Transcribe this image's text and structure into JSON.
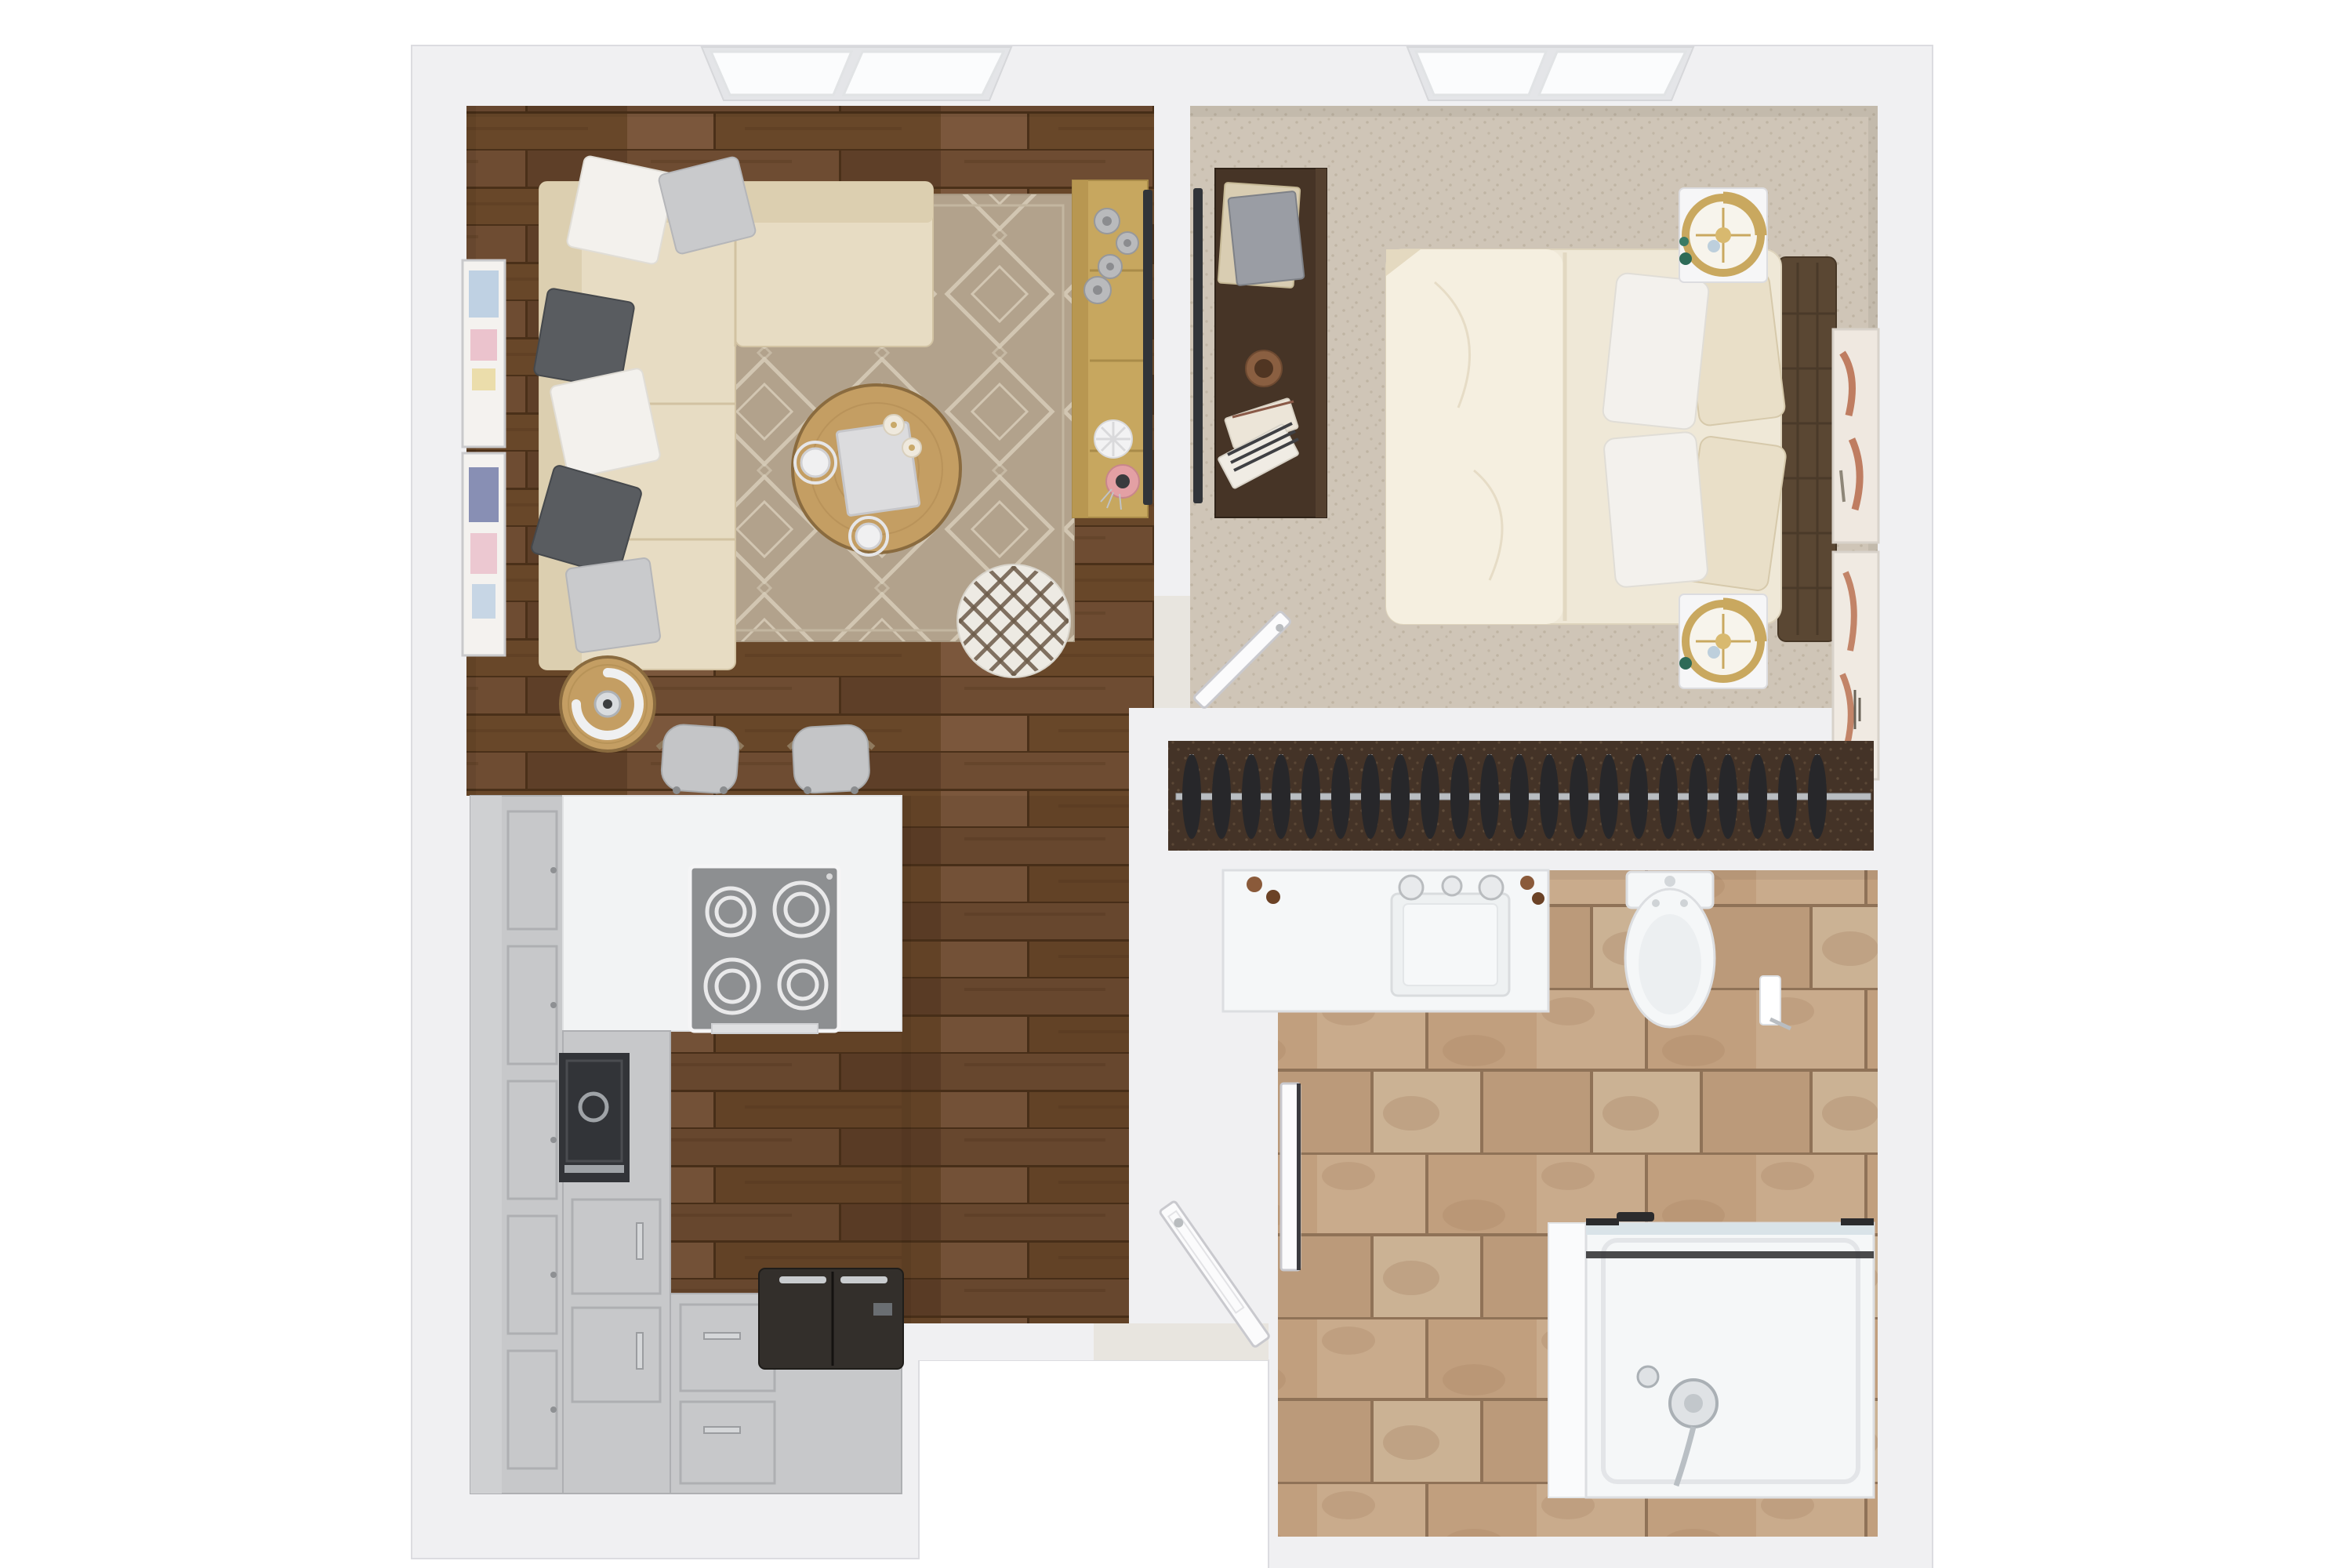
{
  "scene": {
    "type": "3d-floor-plan-top-down",
    "description": "Top-down 3D architectural rendering of a one-bedroom apartment",
    "visible_text": [],
    "rooms": [
      {
        "id": "living-room",
        "floor": "dark hardwood planks",
        "features": [
          "double window",
          "area rug"
        ]
      },
      {
        "id": "kitchen",
        "floor": "dark hardwood planks",
        "layout": "L-shaped gray cabinets with white peninsula counter"
      },
      {
        "id": "hallway",
        "floor": "dark hardwood planks"
      },
      {
        "id": "entry",
        "feature": "open front door at recessed porch"
      },
      {
        "id": "bedroom",
        "floor": "beige carpet",
        "features": [
          "double window"
        ]
      },
      {
        "id": "closet",
        "floor": "dark brown carpet",
        "features": [
          "hanging rod with clothes hangers"
        ]
      },
      {
        "id": "bathroom",
        "floor": "beige stone tile"
      }
    ]
  },
  "living_room": {
    "furniture": [
      "l-shaped-sectional-sofa",
      "throw-pillows",
      "round-coffee-table",
      "round-pouf",
      "round-side-table-with-arc-lamp",
      "media-console",
      "wall-mounted-tv",
      "wall-art-frames",
      "area-rug"
    ],
    "sofa_pillow_count": 6,
    "coffee_table_items": [
      "book",
      "two-cups-with-saucers",
      "two-candles"
    ],
    "console_items": [
      "gray-candle-cups",
      "white-flower-dish",
      "pink-vase-with-plant"
    ]
  },
  "kitchen": {
    "appliances": [
      "four-burner-cooktop",
      "wall-oven",
      "refrigerator"
    ],
    "burner_count": 4,
    "bar_stool_count": 2,
    "cabinet_finish": "gray shaker"
  },
  "bedroom": {
    "furniture": [
      "queen-bed",
      "tufted-headboard",
      "two-nightstands",
      "two-gold-ring-lamps",
      "desk-dresser",
      "wall-mounted-tv",
      "wall-art-canvases"
    ],
    "bed_pillow_count": 4,
    "nightstand_count": 2
  },
  "closet": {
    "hanger_count": 22,
    "rod": "metal closet rod"
  },
  "bathroom": {
    "fixtures": [
      "vanity-with-sink",
      "toilet",
      "toilet-paper-holder",
      "walk-in-shower-with-glass-panel",
      "chrome-shower-set"
    ],
    "open_door": true
  },
  "entry": {
    "door_state": "open",
    "porch": "recessed exterior notch at bottom center"
  },
  "windows": [
    {
      "room": "living-room",
      "pane_count": 2
    },
    {
      "room": "bedroom",
      "pane_count": 2
    }
  ],
  "colors": {
    "background": "#ffffff",
    "wall": "#f0f0f2",
    "wall_edge": "#dcdce0",
    "wood_1": "#6e4c32",
    "wood_2": "#5e3f28",
    "wood_3": "#7b573c",
    "wood_4": "#684729",
    "wood_gap": "#4a3019",
    "rug_base": "#b2a28c",
    "rug_pattern": "#d9cfbc",
    "sofa": "#e7dcc3",
    "sofa_back": "#dccfb0",
    "sofa_edge": "#d2c3a3",
    "pillow_white": "#f3f1ed",
    "pillow_gray_light": "#c9cacc",
    "pillow_gray_dark": "#595c60",
    "table_wood": "#c49e63",
    "console_wood": "#c7a75f",
    "pouf": "#edeae3",
    "pouf_lattice": "#6d5b49",
    "carpet": "#cfc5b7",
    "carpet_speckle": "#b4a896",
    "desk_wood": "#463426",
    "duvet": "#efe8d7",
    "duvet_light": "#f5efe0",
    "pillow_cream": "#e9dfc8",
    "headboard": "#5a4733",
    "nightstand": "#f6f6f7",
    "lamp_gold": "#c9a85f",
    "closet_floor": "#443327",
    "hanger": "#27272a",
    "rod": "#b9bdc1",
    "tile_1": "#c9ab8c",
    "tile_2": "#c19f7e",
    "tile_3": "#cbb294",
    "tile_4": "#bb9a7a",
    "grout": "#8f7257",
    "tile_mottle": "#a37f5f",
    "fixture_white": "#f5f7f8",
    "fixture_edge": "#dcdee1",
    "shower_glass": "#d9e3e8",
    "shower_frame": "#2b2b2d",
    "cabinet": "#c7c8ca",
    "cabinet_edge": "#aeafb2",
    "counter": "#f2f3f4",
    "cooktop": "#8d8f91",
    "burner": "#e9e9ea",
    "appliance_dark": "#323438",
    "fridge": "#332f2b",
    "door": "#fbfbfc",
    "door_edge": "#c9c9ce",
    "window_glass": "#fbfcfd",
    "window_frame": "#e4e5e8",
    "art_pink": "#e8b7c4",
    "art_blue": "#a8c3de",
    "art_yellow": "#e8d79a",
    "art_navy": "#3f4c8c",
    "art_rust": "#b66a4a",
    "vase_pink": "#e3a0a4",
    "plant_green": "#2e6b57",
    "cup_brown": "#8a5f41"
  }
}
